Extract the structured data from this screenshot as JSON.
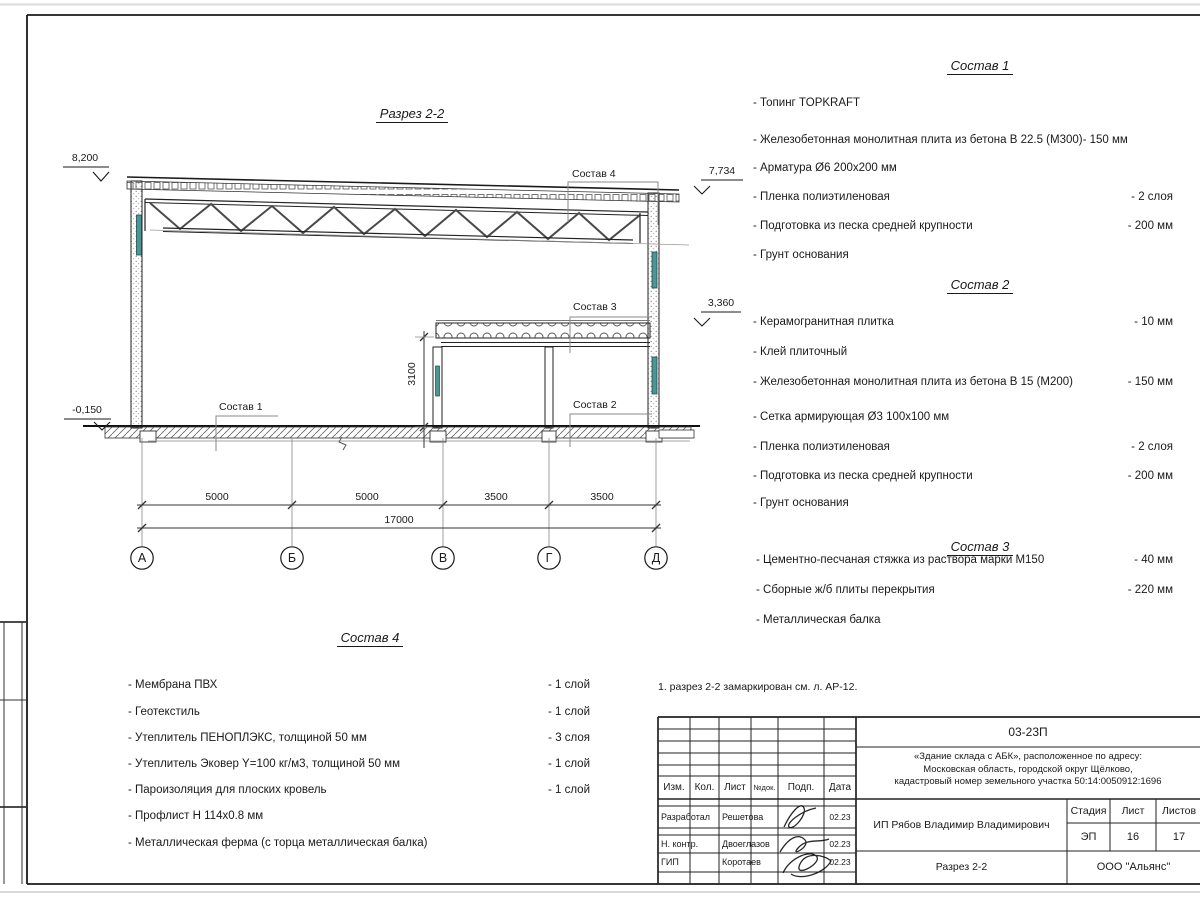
{
  "drawing": {
    "title": "Разрез 2-2",
    "note": "1. разрез 2-2 замаркирован см. л. АР-12.",
    "elevations": [
      "8,200",
      "7,734",
      "3,360",
      "-0,150"
    ],
    "axes": [
      "А",
      "Б",
      "В",
      "Г",
      "Д"
    ],
    "dims": {
      "spans": [
        "5000",
        "5000",
        "3500",
        "3500"
      ],
      "total": "17000",
      "height": "3100"
    },
    "callouts": {
      "c1": "Состав 1",
      "c2": "Состав  2",
      "c3": "Состав  3",
      "c4": "Состав  4"
    }
  },
  "compositions": [
    {
      "title": "Состав 1",
      "items": [
        {
          "text": "- Топинг TOPKRAFT",
          "value": ""
        },
        {
          "text": "- Железобетонная  монолитная плита из бетона  В 22.5 (М300)- 150 мм",
          "value": ""
        },
        {
          "text": "- Арматура Ø6 200х200 мм",
          "value": ""
        },
        {
          "text": "- Пленка полиэтиленовая",
          "value": "-  2 слоя"
        },
        {
          "text": "- Подготовка из песка средней  крупности",
          "value": "- 200 мм"
        },
        {
          "text": "- Грунт основания",
          "value": ""
        }
      ]
    },
    {
      "title": "Состав 2",
      "items": [
        {
          "text": "- Керамогранитная плитка",
          "value": "- 10 мм"
        },
        {
          "text": "- Клей плиточный",
          "value": ""
        },
        {
          "text": "- Железобетонная  монолитная плита из бетона В 15 (М200)",
          "value": "- 150 мм"
        },
        {
          "text": "- Сетка армирующая Ø3 100х100 мм",
          "value": ""
        },
        {
          "text": "- Пленка полиэтиленовая",
          "value": "-  2 слоя"
        },
        {
          "text": "- Подготовка из песка средней  крупности",
          "value": "- 200 мм"
        },
        {
          "text": "- Грунт основания",
          "value": ""
        }
      ]
    },
    {
      "title": "Состав 3",
      "items": [
        {
          "text": "- Цементно-песчаная стяжка  из раствора марки М150",
          "value": "- 40 мм"
        },
        {
          "text": "- Сборные ж/б плиты перекрытия",
          "value": "- 220 мм"
        },
        {
          "text": "- Металлическая  балка",
          "value": ""
        }
      ]
    },
    {
      "title": "Состав 4",
      "items": [
        {
          "text": "- Мембрана ПВХ",
          "value": "- 1 слой"
        },
        {
          "text": "- Геотекстиль",
          "value": "- 1 слой"
        },
        {
          "text": "- Утеплитель ПЕНОПЛЭКС, толщиной 50 мм",
          "value": "- 3 слоя"
        },
        {
          "text": "- Утеплитель Эковер Y=100 кг/м3, толщиной 50 мм",
          "value": "- 1 слой"
        },
        {
          "text": "- Пароизоляция для плоских кровель",
          "value": "- 1 слой"
        },
        {
          "text": "- Профлист Н 114х0.8 мм",
          "value": ""
        },
        {
          "text": "- Металлическая ферма (с торца металлическая балка)",
          "value": ""
        }
      ]
    }
  ],
  "titleblock": {
    "code": "03-23П",
    "address_line1": "«Здание склада с АБК», расположенное по адресу:",
    "address_line2": "Московская область, городской округ Щёлково,",
    "address_line3": "кадастровый номер земельного участка 50:14:0050912:1696",
    "client": "ИП Рябов Владимир Владимирович",
    "doc_title": "Разрез 2-2",
    "company": "ООО \"Альянс\"",
    "headers": {
      "izm": "Изм.",
      "kol": "Кол.",
      "list": "Лист",
      "ndok": "№док.",
      "podp": "Подп.",
      "data": "Дата"
    },
    "stage_label": "Стадия",
    "sheet_label": "Лист",
    "sheets_label": "Листов",
    "stage": "ЭП",
    "sheet": "16",
    "sheets": "17",
    "rows": [
      {
        "role": "Разработал",
        "name": "Решетова",
        "date": "02.23"
      },
      {
        "role": "Н. контр.",
        "name": "Двоеглазов",
        "date": "02.23"
      },
      {
        "role": "ГИП",
        "name": "Коротаев",
        "date": "02.23"
      }
    ]
  },
  "colors": {
    "accent_teal": "#4d9494",
    "line": "#1a1a1a"
  }
}
